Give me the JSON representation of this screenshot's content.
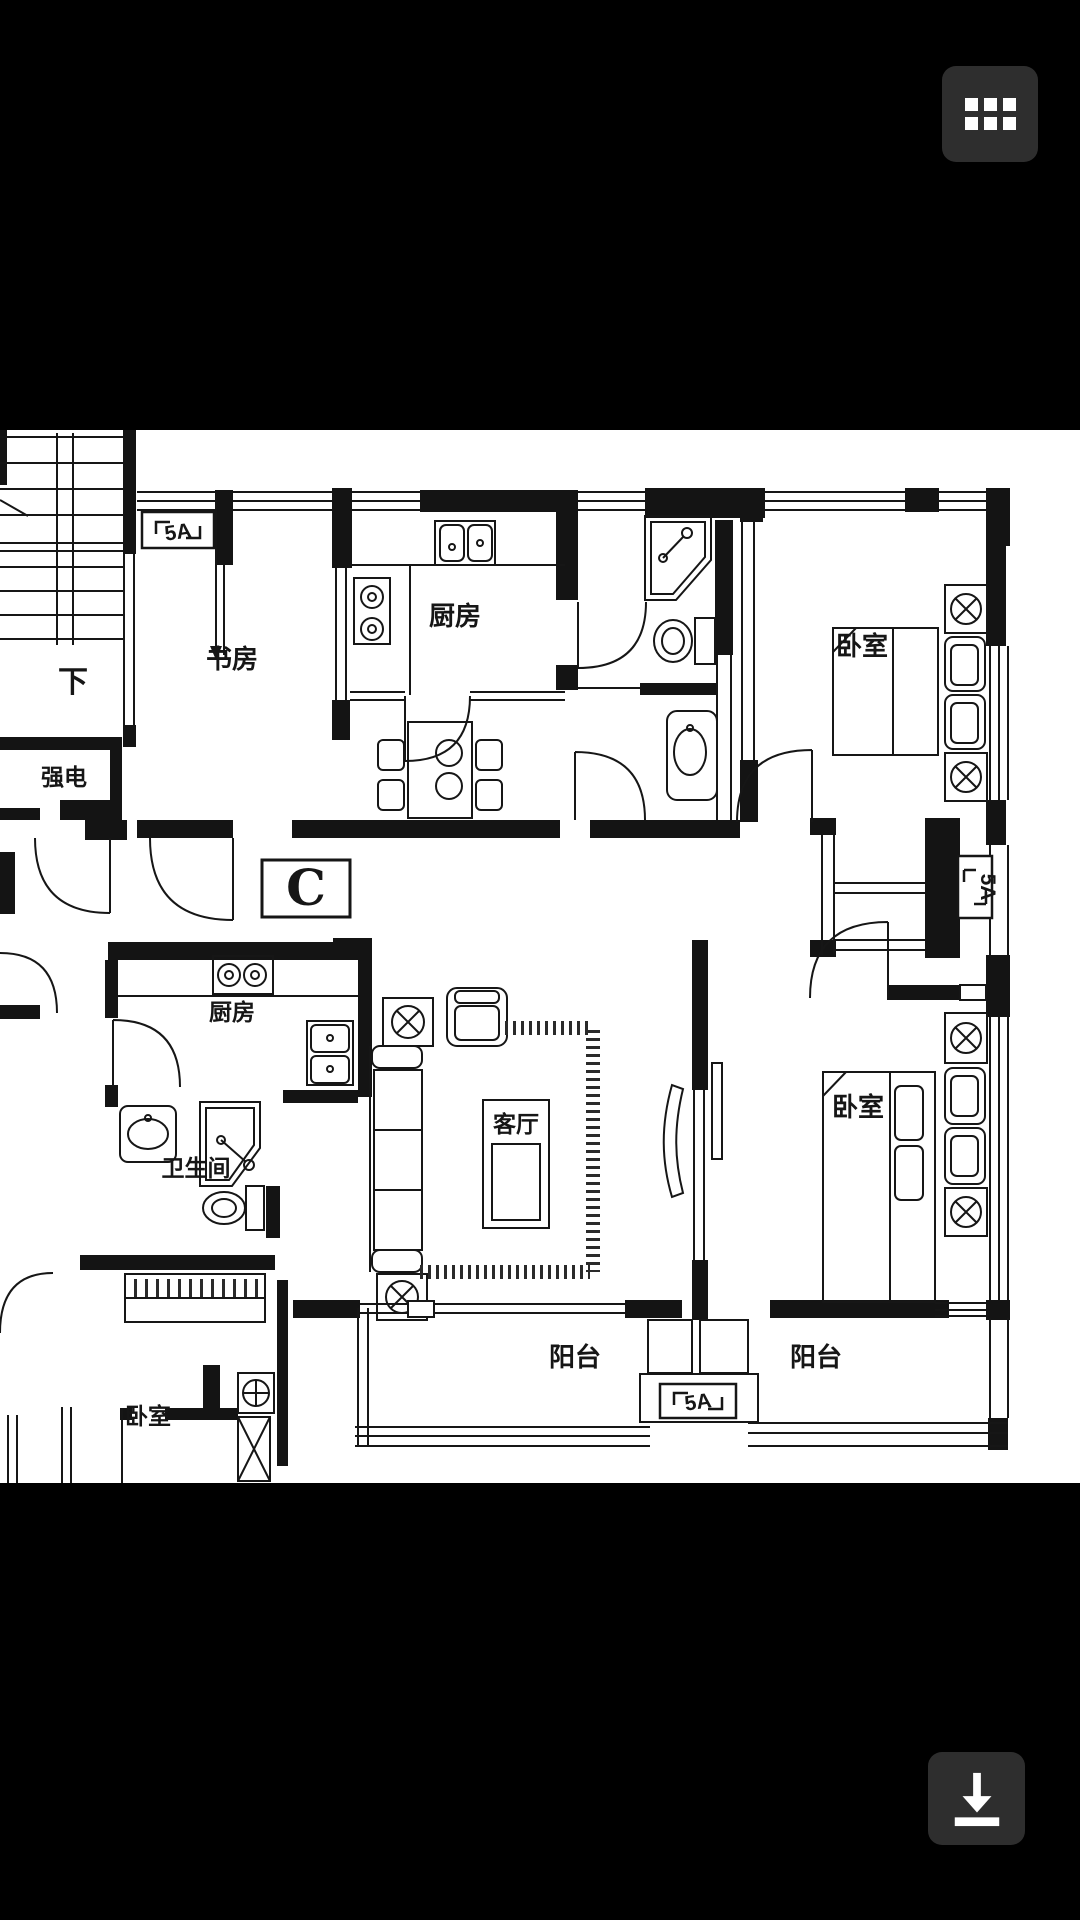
{
  "screen": {
    "background": "#000000"
  },
  "viewer": {
    "menu_button": {
      "icon": "grid-icon"
    },
    "download_button": {
      "icon": "download-icon"
    }
  },
  "floorplan": {
    "unit_label": "C",
    "rooms": {
      "stairs_down": "下",
      "study": "书房",
      "kitchen_upper": "厨房",
      "bedroom_top_right": "卧室",
      "electrical_room": "强电",
      "kitchen_lower": "厨房",
      "living_room": "客厅",
      "bathroom_lower": "卫生间",
      "bedroom_bottom_right": "卧室",
      "balcony_left": "阳台",
      "balcony_right": "阳台",
      "bedroom_bottom_left": "卧室"
    },
    "markers": {
      "ac_top": "5A",
      "ac_right": "5A",
      "ac_bottom": "5A"
    },
    "colors": {
      "paper": "#ffffff",
      "ink": "#161616",
      "button": "#2e2e2e"
    }
  }
}
